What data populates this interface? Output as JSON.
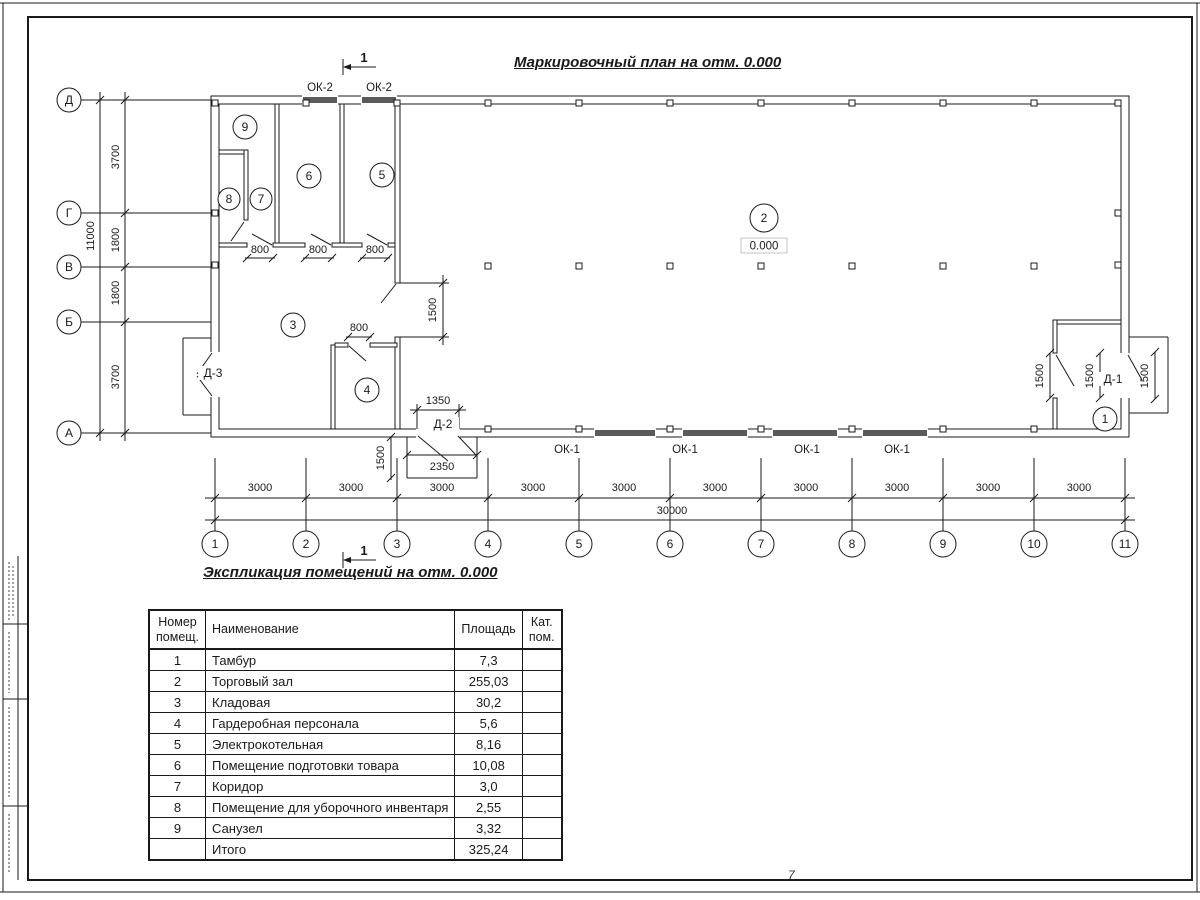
{
  "sheet": {
    "page_mark": "7"
  },
  "main_title": "Маркировочный план на отм. 0.000",
  "plan": {
    "section_label": "1",
    "elevation": "0.000",
    "window_labels": {
      "ok1": "ОК-1",
      "ok2": "ОК-2"
    },
    "door_labels": {
      "d1": "Д-1",
      "d2": "Д-2",
      "d3": "Д-3"
    },
    "dims": {
      "bay": "3000",
      "total_width": "30000",
      "total_height": "11000",
      "left_bays": [
        "3700",
        "1800",
        "1800",
        "3700"
      ],
      "door_800": "800",
      "door_1500": "1500",
      "d2_1350": "1350",
      "d2_2350": "2350"
    },
    "axes_bottom": [
      "1",
      "2",
      "3",
      "4",
      "5",
      "6",
      "7",
      "8",
      "9",
      "10",
      "11"
    ],
    "axes_left": [
      "Д",
      "Г",
      "В",
      "Б",
      "А"
    ]
  },
  "table": {
    "title": "Экспликация помещений на отм. 0.000",
    "headers": {
      "number": "Номер\nпомещ.",
      "name": "Наименование",
      "area": "Площадь",
      "cat": "Кат.\nпом."
    },
    "rows": [
      {
        "number": "1",
        "name": "Тамбур",
        "area": "7,3",
        "cat": ""
      },
      {
        "number": "2",
        "name": "Торговый зал",
        "area": "255,03",
        "cat": ""
      },
      {
        "number": "3",
        "name": "Кладовая",
        "area": "30,2",
        "cat": ""
      },
      {
        "number": "4",
        "name": "Гардеробная персонала",
        "area": "5,6",
        "cat": ""
      },
      {
        "number": "5",
        "name": "Электрокотельная",
        "area": "8,16",
        "cat": ""
      },
      {
        "number": "6",
        "name": "Помещение подготовки товара",
        "area": "10,08",
        "cat": ""
      },
      {
        "number": "7",
        "name": "Коридор",
        "area": "3,0",
        "cat": ""
      },
      {
        "number": "8",
        "name": "Помещение для уборочного инвентаря",
        "area": "2,55",
        "cat": ""
      },
      {
        "number": "9",
        "name": "Санузел",
        "area": "3,32",
        "cat": ""
      },
      {
        "number": "",
        "name": "Итого",
        "area": "325,24",
        "cat": ""
      }
    ]
  }
}
